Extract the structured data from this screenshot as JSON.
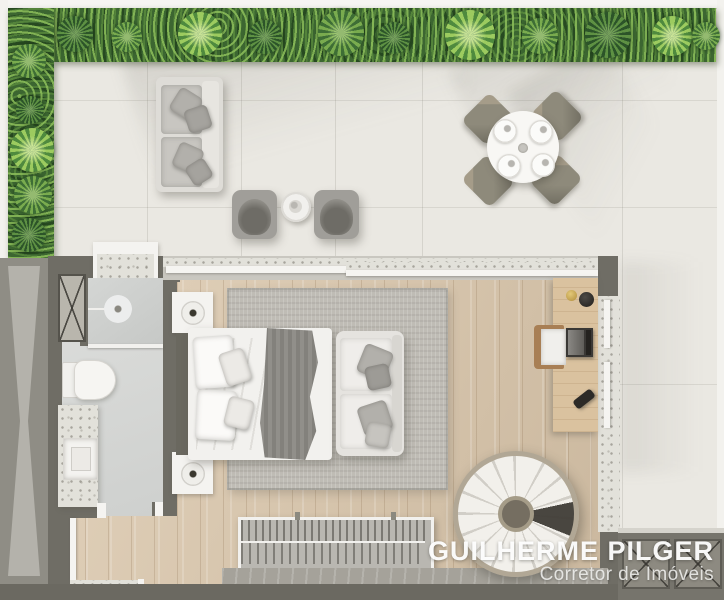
{
  "watermark": {
    "name": "GUILHERME PILGER",
    "role": "Corretor de Imóveis"
  },
  "plan": {
    "type": "apartment-floor-plan-top-view",
    "areas": [
      "terrace",
      "outdoor-lounge",
      "outdoor-dining",
      "bathroom",
      "bedroom",
      "entry-hall",
      "desk-area",
      "spiral-staircase-corner"
    ],
    "furniture": [
      "outdoor-sofa",
      "lounge-chair",
      "lounge-chair",
      "side-table",
      "round-dining-table",
      "dining-chairs-x4",
      "double-bed",
      "nightstand-with-lamp",
      "nightstand-with-lamp",
      "bedroom-sofa",
      "area-rug",
      "clothes-rack",
      "desk",
      "desk-chair",
      "laptop",
      "toilet",
      "shower",
      "vanity-sink",
      "spiral-staircase"
    ]
  },
  "palette": {
    "terrace_tile": "#eae8e2",
    "hedge_green": "#3c6631",
    "wall_gray": "#6f6d65",
    "wood_floor": "#d8c6ad",
    "rug_gray": "#bfbcb5",
    "furniture_white": "#f4f3f0",
    "watermark_white": "#ffffff"
  }
}
